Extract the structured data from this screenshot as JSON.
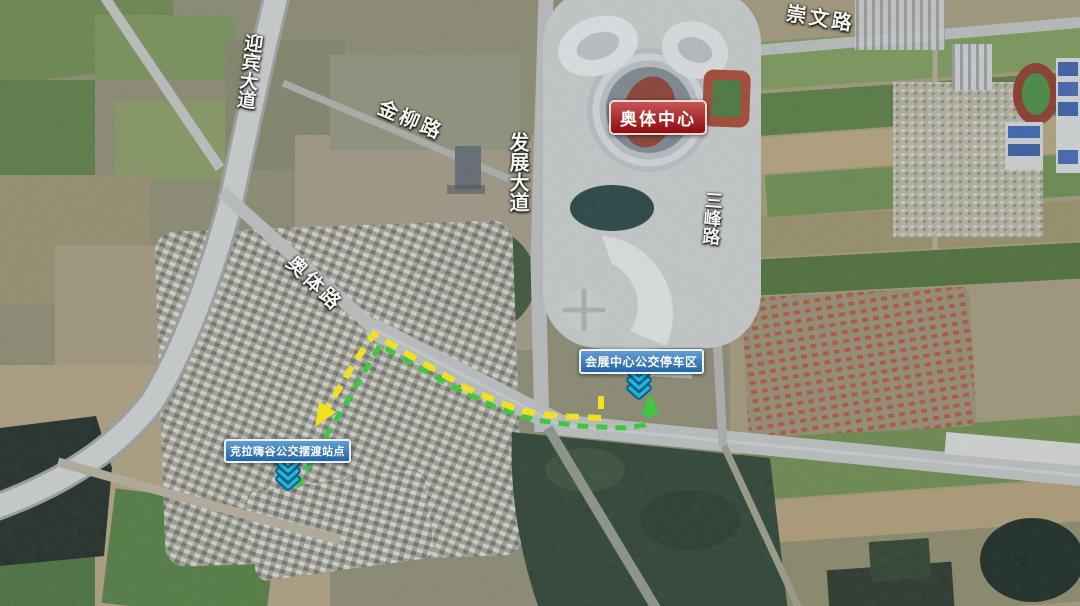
{
  "road_labels": {
    "yingbin_avenue": "迎宾大道",
    "jinliu_road": "金柳路",
    "fazhan_avenue": "发展大道",
    "chongwen_road": "崇文路",
    "sanfeng_road": "三峰路",
    "aoti_road": "奥体路"
  },
  "poi_labels": {
    "olympic_center": "奥体中心",
    "exhibition_parking": "会展中心公交停车区",
    "shuttle_station": "克拉嗨谷公交摆渡站点"
  },
  "routes": {
    "yellow": {
      "color": "#f2e11f",
      "style": "dashed"
    },
    "green": {
      "color": "#3cc940",
      "style": "dashed"
    }
  },
  "icons": {
    "down_chevron_color": "#27b3dc",
    "down_chevron_outline": "#0c5f86"
  },
  "badge_colors": {
    "olympic_center_bg": "#b01215",
    "olympic_center_border": "#eadcd4",
    "bus_label_bg": "#2e7cc3",
    "bus_label_border": "#e9f1f7"
  }
}
